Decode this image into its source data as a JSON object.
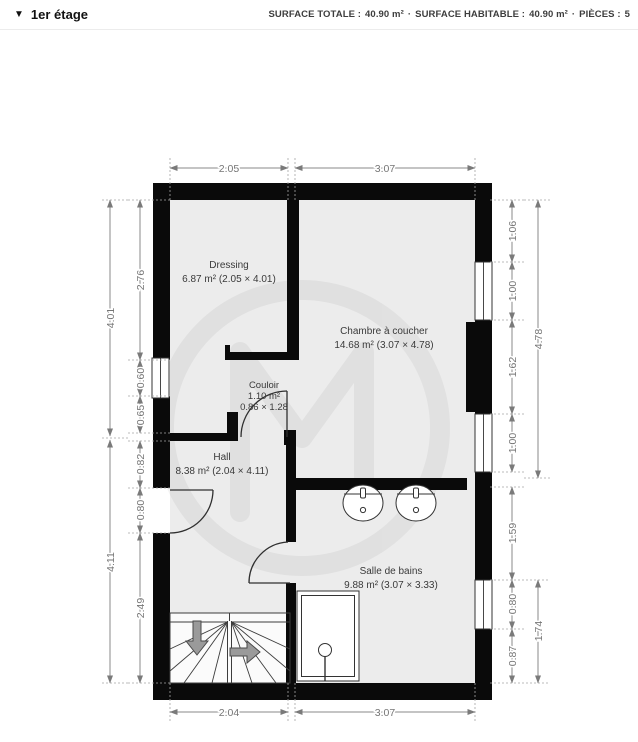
{
  "header": {
    "collapse_icon": "▼",
    "floor_label": "1er étage",
    "stats": [
      {
        "label": "SURFACE TOTALE :",
        "value": "40.90 m²"
      },
      {
        "label": "SURFACE HABITABLE :",
        "value": "40.90 m²"
      },
      {
        "label": "PIÈCES :",
        "value": "5"
      }
    ],
    "separator": "·"
  },
  "rooms": [
    {
      "name": "Dressing",
      "area": "6.87 m² (2.05 × 4.01)"
    },
    {
      "name": "Chambre à coucher",
      "area": "14.68 m² (3.07 × 4.78)"
    },
    {
      "name": "Couloir",
      "area": "1.10 m²",
      "dims": "0.86 × 1.28"
    },
    {
      "name": "Hall",
      "area": "8.38 m² (2.04 × 4.11)"
    },
    {
      "name": "Salle de bains",
      "area": "9.88 m² (3.07 × 3.33)"
    }
  ],
  "dimensions": {
    "top": [
      "2.05",
      "3.07"
    ],
    "bottom": [
      "2.04",
      "3.07"
    ],
    "left_outer": [
      "4.01",
      "4.11"
    ],
    "left_inner": [
      "2.76",
      "0.60",
      "0.65",
      "0.82",
      "0.80",
      "2.49"
    ],
    "right_inner": [
      "1.06",
      "1.00",
      "1.62",
      "1.00",
      "1.59",
      "0.80",
      "0.87"
    ],
    "right_outer": [
      "4.78",
      "1.74"
    ]
  },
  "colors": {
    "wall": "#0a0a0a",
    "floor": "#ececec",
    "dimension": "#757575",
    "stairs_arrow": "#9a9a9a"
  }
}
